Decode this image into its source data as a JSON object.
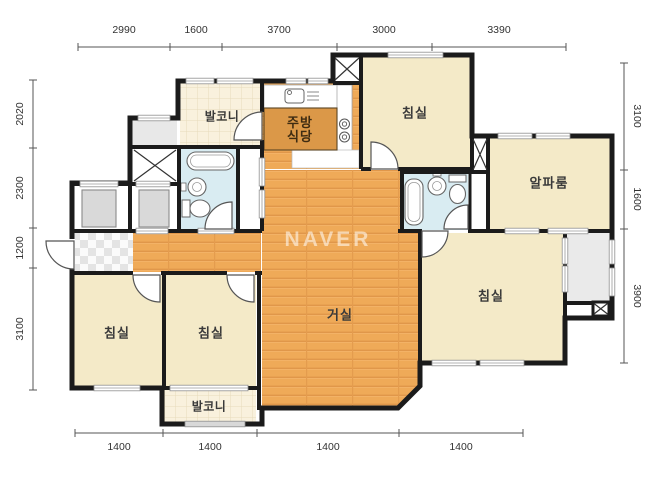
{
  "watermark": "NAVER",
  "rooms": {
    "balcony_top": {
      "label": "발코니"
    },
    "kitchen": {
      "line1": "주방",
      "line2": "식당"
    },
    "bedroom_top": {
      "label": "침실"
    },
    "alpha_room": {
      "label": "알파룸"
    },
    "living_room": {
      "label": "거실"
    },
    "bedroom_master": {
      "label": "침실"
    },
    "bedroom_left": {
      "label": "침실"
    },
    "bedroom_center": {
      "label": "침실"
    },
    "balcony_bottom": {
      "label": "발코니"
    }
  },
  "dimensions": {
    "top": [
      "2990",
      "1600",
      "3700",
      "3000",
      "3390"
    ],
    "bottom": [
      "1400",
      "1400",
      "1400",
      "1400"
    ],
    "left": [
      "2020",
      "2300",
      "1200",
      "3100"
    ],
    "right": [
      "3100",
      "1600",
      "3900"
    ]
  },
  "colors": {
    "wall": "#1b1b1b",
    "wood_floor": "#efaa58",
    "room_fill": "#f4eac8",
    "bathroom_fill": "#d9ecf2",
    "balcony_fill": "#f9f1dd",
    "counter_fill": "#db9848",
    "gray_fill": "#e9e9e9",
    "dimension_text": "#333333"
  }
}
